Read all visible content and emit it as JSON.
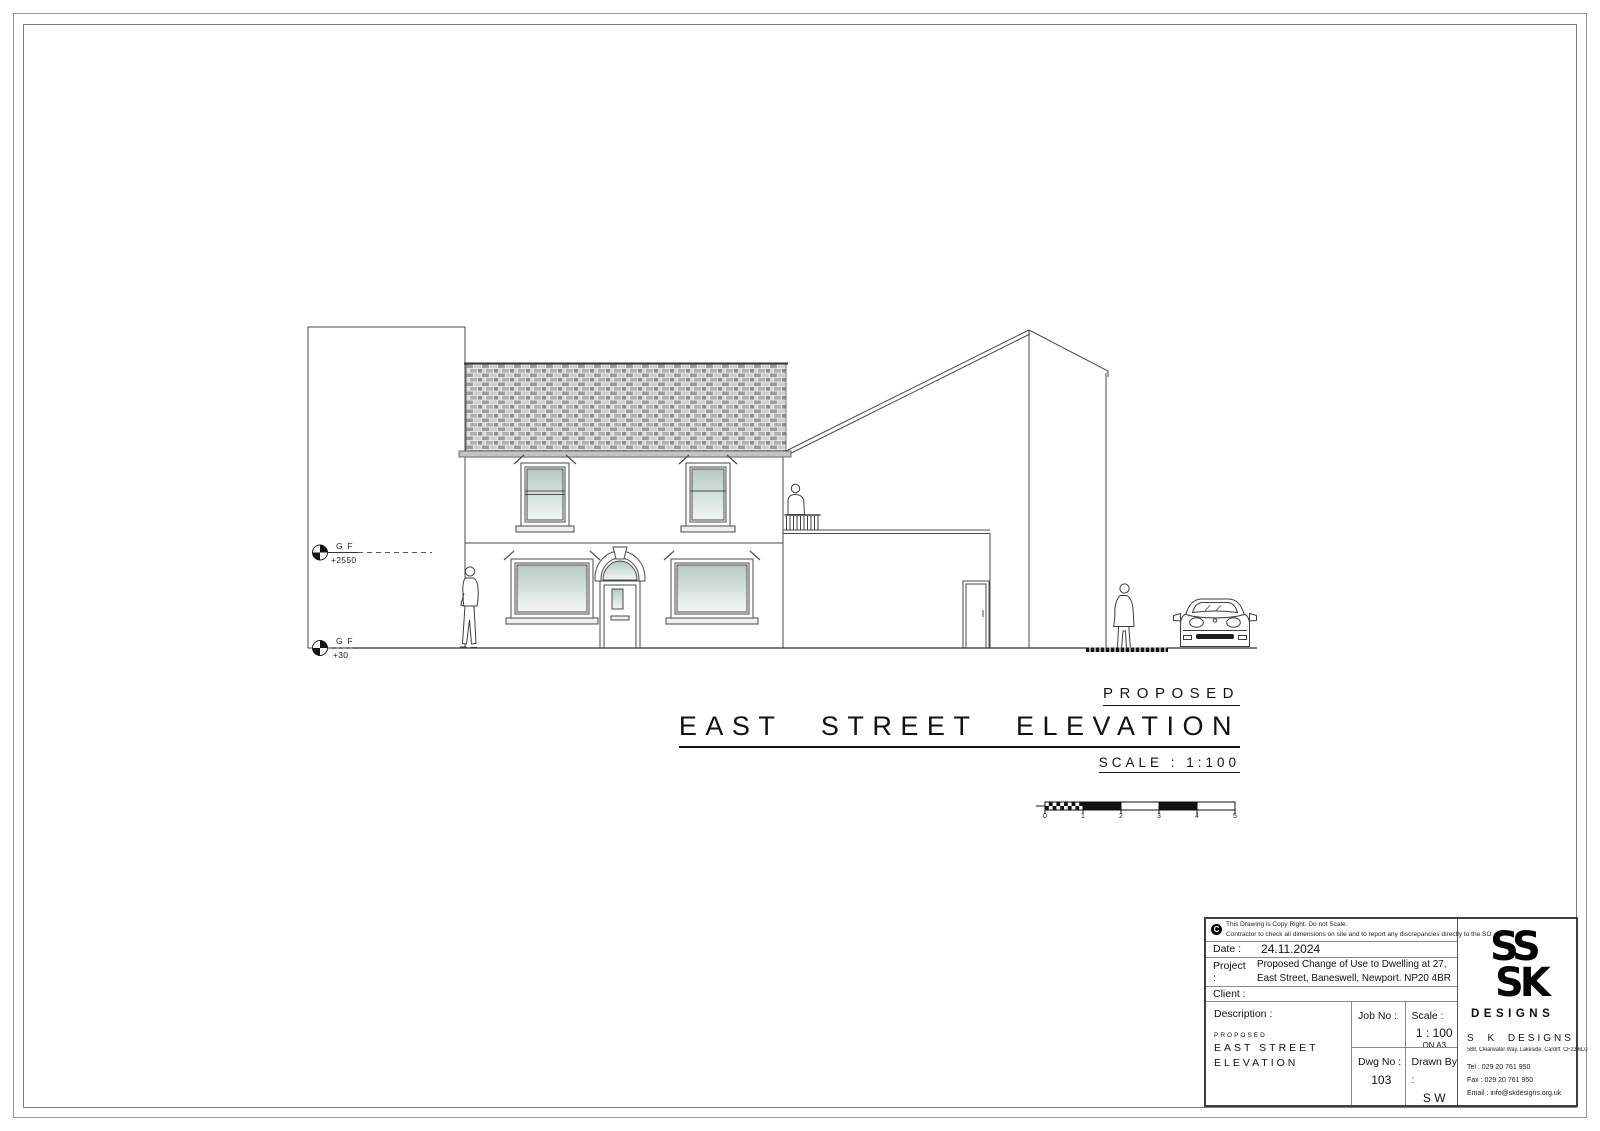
{
  "levels": {
    "upper": {
      "label": "G F",
      "value": "+2550"
    },
    "ground": {
      "label": "G F",
      "value": "+30"
    }
  },
  "titles": {
    "pretitle": "PROPOSED",
    "main": "EAST STREET ELEVATION",
    "scale": "SCALE : 1:100"
  },
  "scale_bar": {
    "ticks": [
      "0",
      "1",
      "2",
      "3",
      "4",
      "5"
    ]
  },
  "title_block": {
    "copyright_icon": "C",
    "copyright_line1": "This Drawing is Copy Right.  Do not Scale.",
    "copyright_line2": "Contractor to check all dimensions on site and to report any discrepancies directly to the SO",
    "date_label": "Date :",
    "date_value": "24.11.2024",
    "project_label": "Project :",
    "project_line1": "Proposed Change of Use to Dwelling at 27,",
    "project_line2": "East Street, Baneswell, Newport. NP20 4BR",
    "client_label": "Client  :",
    "description_label": "Description  :",
    "description_pre": "PROPOSED",
    "description_line1": "EAST STREET",
    "description_line2": "ELEVATION",
    "job_no_label": "Job No :",
    "scale_label": "Scale :",
    "scale_value": "1 : 100",
    "scale_sub": "ON A3",
    "dwg_no_label": "Dwg No :",
    "dwg_no_value": "103",
    "drawn_by_label": "Drawn By :",
    "drawn_by_value": "S W",
    "firm": {
      "logo_top": "SS",
      "logo_bottom": "SK",
      "logo_caption": "DESIGNS",
      "name": "S K DESIGNS",
      "address": "588, Clearwater Way, Lakeside, Cardiff. CF23 6DJ",
      "tel": "Tel : 029 20 761 950",
      "fax": "Fax : 029 20 761 950",
      "email": "Email : info@skdesigns.org.uk"
    }
  },
  "colors": {
    "line": "#3f3f3f",
    "eaves_gray": "#c4c4c4",
    "glass_tint": "#b7c9c2",
    "ink": "#111111"
  }
}
